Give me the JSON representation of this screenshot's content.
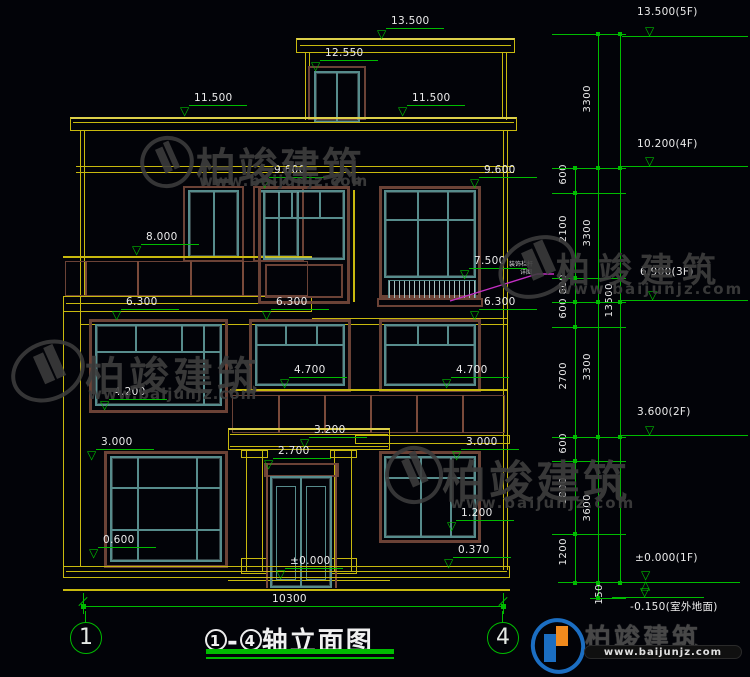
{
  "drawing": {
    "title_num_left": "1",
    "title_num_right": "4",
    "title_dash": "-",
    "title_suffix": "轴立面图",
    "axis_bubbles": [
      "1",
      "4"
    ],
    "bottom_dim": "10300"
  },
  "facade_markers": [
    {
      "text": "13.500",
      "x": 383,
      "y": 40
    },
    {
      "text": "12.550",
      "x": 317,
      "y": 72
    },
    {
      "text": "11.500",
      "x": 186,
      "y": 117
    },
    {
      "text": "11.500",
      "x": 404,
      "y": 117
    },
    {
      "text": "9.600",
      "x": 266,
      "y": 189
    },
    {
      "text": "9.600",
      "x": 476,
      "y": 189
    },
    {
      "text": "8.000",
      "x": 138,
      "y": 256
    },
    {
      "text": "7.500",
      "x": 466,
      "y": 280
    },
    {
      "text": "6.300",
      "x": 118,
      "y": 321
    },
    {
      "text": "6.300",
      "x": 268,
      "y": 321
    },
    {
      "text": "6.300",
      "x": 476,
      "y": 321
    },
    {
      "text": "4.700",
      "x": 286,
      "y": 389
    },
    {
      "text": "4.700",
      "x": 448,
      "y": 389
    },
    {
      "text": "4.200",
      "x": 106,
      "y": 411
    },
    {
      "text": "3.200",
      "x": 306,
      "y": 449
    },
    {
      "text": "3.000",
      "x": 93,
      "y": 461
    },
    {
      "text": "3.000",
      "x": 458,
      "y": 461
    },
    {
      "text": "2.700",
      "x": 270,
      "y": 470
    },
    {
      "text": "1.200",
      "x": 453,
      "y": 532
    },
    {
      "text": "0.600",
      "x": 95,
      "y": 559
    },
    {
      "text": "0.370",
      "x": 450,
      "y": 569
    },
    {
      "text": "±0.000",
      "x": 282,
      "y": 580
    }
  ],
  "right_markers": [
    {
      "text": "13.500(5F)",
      "x": 637,
      "y": 6,
      "level": 37,
      "kind": "tri"
    },
    {
      "text": "10.200(4F)",
      "x": 637,
      "y": 138,
      "level": 167,
      "kind": "tri"
    },
    {
      "text": "6.900(3F)",
      "x": 640,
      "y": 266,
      "level": 301,
      "kind": "tri"
    },
    {
      "text": "3.600(2F)",
      "x": 637,
      "y": 406,
      "level": 436,
      "kind": "tri"
    },
    {
      "text": "±0.000(1F)",
      "x": 635,
      "y": 552,
      "level": 583,
      "kind": "zero"
    },
    {
      "text": "-0.150(室外地面)",
      "x": 630,
      "y": 599,
      "level": 598,
      "kind": "ground"
    }
  ],
  "chain": {
    "inner": [
      {
        "v": "600",
        "y": 164
      },
      {
        "v": "2100",
        "y": 215
      },
      {
        "v": "600",
        "y": 274
      },
      {
        "v": "600",
        "y": 298
      },
      {
        "v": "2700",
        "y": 362
      },
      {
        "v": "600",
        "y": 433
      },
      {
        "v": "1800",
        "y": 477
      },
      {
        "v": "1200",
        "y": 538
      }
    ],
    "middle": [
      {
        "v": "3300",
        "y": 85
      },
      {
        "v": "3300",
        "y": 219
      },
      {
        "v": "3300",
        "y": 353
      },
      {
        "v": "3600",
        "y": 494
      }
    ],
    "outer": [
      {
        "v": "13500",
        "y": 283
      }
    ],
    "extra": [
      {
        "v": "150",
        "y": 584
      }
    ]
  },
  "annotation": {
    "line1": "装饰栏杆",
    "line2": "详图"
  },
  "watermark": {
    "brand": "柏竣建筑",
    "url": "www.baijunjz.com"
  },
  "colors": {
    "wall": "#c8b90e",
    "dim": "#00bb00",
    "frame": "#578c8c",
    "trim": "#6b4236",
    "leader": "#c32fc3",
    "logo_blue": "#1b6ec2",
    "logo_orange": "#f08a1d"
  }
}
